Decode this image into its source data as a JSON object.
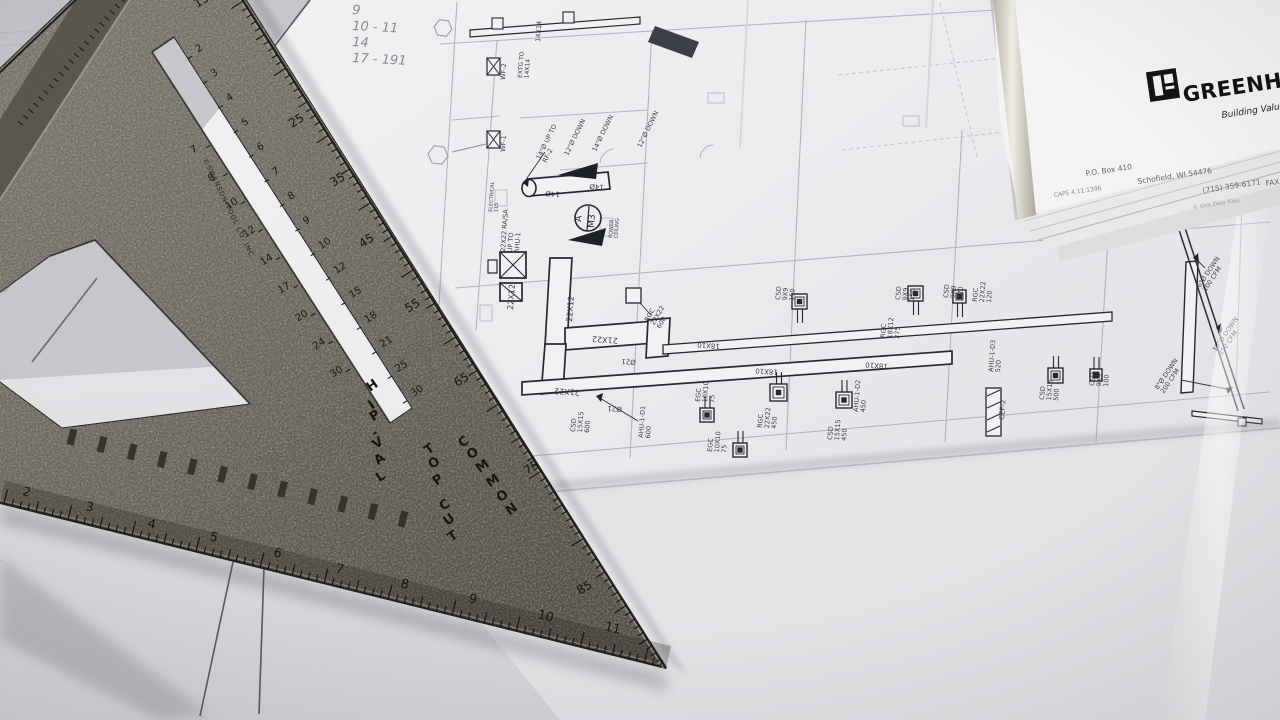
{
  "scene": {
    "description": "photo of HVAC blueprint sheets on a desk with a metal speed square on top"
  },
  "letterhead": {
    "brand": "GREENHECK",
    "tagline": "Building Value",
    "po_box": "P.O. Box 410",
    "city": "Schofield, WI 54476",
    "phone": "(715) 359-6171",
    "fax": "FAX",
    "code": "CAPS 4.11.1396",
    "fineprint": "© Unit Data Files"
  },
  "speed_square": {
    "brand": "©SWANSON TOOL CO. INC.",
    "label_hip_val": "HIP-VAL",
    "label_top_cut": "TOP CUT",
    "label_common": "COMMON",
    "inch_numbers": [
      "2",
      "3",
      "4",
      "5",
      "6",
      "7",
      "8",
      "9",
      "10",
      "11"
    ],
    "degree_numbers": [
      "15",
      "25",
      "35",
      "45",
      "55",
      "65",
      "75",
      "85"
    ],
    "upper_slot_scale": [
      "2",
      "3",
      "4",
      "5",
      "6",
      "7",
      "8",
      "9",
      "10",
      "12",
      "15",
      "18",
      "21",
      "25",
      "30"
    ],
    "lower_slot_scale": [
      "7",
      "8",
      "10",
      "12",
      "14",
      "17",
      "20",
      "24",
      "30"
    ]
  },
  "blueprint": {
    "handwritten_notes": [
      "9",
      "10 - 11",
      "14",
      "17 - 191"
    ],
    "section_marker": {
      "top": "A",
      "bottom": "M3"
    },
    "labels": [
      {
        "t": [
          "22X12"
        ],
        "x": 513,
        "y": 310,
        "r": -86,
        "s": 8
      },
      {
        "t": [
          "22X12"
        ],
        "x": 572,
        "y": 322,
        "r": -86,
        "s": 8
      },
      {
        "t": [
          "21X22"
        ],
        "x": 618,
        "y": 338,
        "r": 184,
        "s": 8
      },
      {
        "t": [
          "21X22"
        ],
        "x": 580,
        "y": 390,
        "r": 184,
        "s": 8
      },
      {
        "t": [
          "Ø21"
        ],
        "x": 636,
        "y": 360,
        "r": 184,
        "s": 7
      },
      {
        "t": [
          "Ø21"
        ],
        "x": 622,
        "y": 407,
        "r": 184,
        "s": 7
      },
      {
        "t": [
          "14Ø"
        ],
        "x": 560,
        "y": 192,
        "r": 184,
        "s": 7
      },
      {
        "t": [
          "14Ø"
        ],
        "x": 604,
        "y": 185,
        "r": 184,
        "s": 7
      },
      {
        "t": [
          "CSD",
          "15X15",
          "600"
        ],
        "x": 575,
        "y": 432,
        "r": -86,
        "s": 6.5,
        "lh": 7
      },
      {
        "t": [
          "AHU-1-D1",
          "600"
        ],
        "x": 643,
        "y": 438,
        "r": -86,
        "s": 6.5,
        "lh": 7
      },
      {
        "t": [
          "RGC",
          "22X22",
          "600"
        ],
        "x": 648,
        "y": 322,
        "r": -60,
        "s": 6.5,
        "lh": 7
      },
      {
        "t": [
          "18X10"
        ],
        "x": 720,
        "y": 344,
        "r": 184,
        "s": 7
      },
      {
        "t": [
          "18X10"
        ],
        "x": 778,
        "y": 370,
        "r": 184,
        "s": 7
      },
      {
        "t": [
          "18X10"
        ],
        "x": 888,
        "y": 364,
        "r": 184,
        "s": 7
      },
      {
        "t": [
          "EGC",
          "10X10",
          "75"
        ],
        "x": 700,
        "y": 402,
        "r": -86,
        "s": 6.5,
        "lh": 7
      },
      {
        "t": [
          "EGC",
          "10X10",
          "75"
        ],
        "x": 712,
        "y": 452,
        "r": -86,
        "s": 6.5,
        "lh": 7
      },
      {
        "t": [
          "RGC",
          "22X22",
          "450"
        ],
        "x": 762,
        "y": 428,
        "r": -86,
        "s": 6.5,
        "lh": 7
      },
      {
        "t": [
          "CSD",
          "15X15",
          "450"
        ],
        "x": 832,
        "y": 440,
        "r": -86,
        "s": 6.5,
        "lh": 7
      },
      {
        "t": [
          "AHU-1-D2",
          "450"
        ],
        "x": 858,
        "y": 412,
        "r": -86,
        "s": 6.5,
        "lh": 7
      },
      {
        "t": [
          "CSD",
          "9X9",
          "150"
        ],
        "x": 780,
        "y": 300,
        "r": -86,
        "s": 6.5,
        "lh": 7
      },
      {
        "t": [
          "CSD",
          "9X9",
          "150"
        ],
        "x": 900,
        "y": 300,
        "r": -86,
        "s": 6.5,
        "lh": 7
      },
      {
        "t": [
          "CSD",
          "9X9",
          "120"
        ],
        "x": 948,
        "y": 298,
        "r": -86,
        "s": 6.5,
        "lh": 7
      },
      {
        "t": [
          "RGC",
          "22X22",
          "120"
        ],
        "x": 977,
        "y": 302,
        "r": -86,
        "s": 6.5,
        "lh": 7
      },
      {
        "t": [
          "RGC",
          "18X12",
          "275"
        ],
        "x": 885,
        "y": 338,
        "r": -86,
        "s": 6.5,
        "lh": 7
      },
      {
        "t": [
          "AHU-1-D3",
          "520"
        ],
        "x": 993,
        "y": 372,
        "r": -86,
        "s": 6.5,
        "lh": 7
      },
      {
        "t": [
          "CSD",
          "15X15",
          "500"
        ],
        "x": 1044,
        "y": 400,
        "r": -86,
        "s": 6.5,
        "lh": 7
      },
      {
        "t": [
          "CSD",
          "9X9",
          "100"
        ],
        "x": 1094,
        "y": 386,
        "r": -86,
        "s": 6.5,
        "lh": 7
      },
      {
        "t": [
          "CEF-2"
        ],
        "x": 1004,
        "y": 420,
        "r": -86,
        "s": 7
      },
      {
        "t": [
          "6\"Ø DOWN",
          "100 CFM"
        ],
        "x": 1200,
        "y": 288,
        "r": -56,
        "s": 6.5,
        "lh": 7
      },
      {
        "t": [
          "10\"Ø DOWN",
          "350 CFM"
        ],
        "x": 1216,
        "y": 352,
        "r": -56,
        "s": 6.5,
        "lh": 7
      },
      {
        "t": [
          "8\"Ø DOWN",
          "200 CFM"
        ],
        "x": 1158,
        "y": 390,
        "r": -56,
        "s": 6.5,
        "lh": 7
      },
      {
        "t": [
          "22X22 RA/SA",
          "UP TO",
          "AHU-1"
        ],
        "x": 505,
        "y": 252,
        "r": -86,
        "s": 6.5,
        "lh": 7
      },
      {
        "t": [
          "14\"Ø UP TO",
          "RF-2"
        ],
        "x": 540,
        "y": 160,
        "r": -64,
        "s": 6.5,
        "lh": 7
      },
      {
        "t": [
          "12\"Ø DOWN"
        ],
        "x": 568,
        "y": 156,
        "r": -64,
        "s": 6.5
      },
      {
        "t": [
          "14\"Ø DOWN"
        ],
        "x": 596,
        "y": 152,
        "r": -64,
        "s": 6.5
      },
      {
        "t": [
          "12\"Ø DOWN"
        ],
        "x": 641,
        "y": 148,
        "r": -64,
        "s": 6.5
      },
      {
        "t": [
          "WF-2"
        ],
        "x": 505,
        "y": 80,
        "r": -86,
        "s": 6.5
      },
      {
        "t": [
          "WF-1"
        ],
        "x": 505,
        "y": 152,
        "r": -86,
        "s": 6.5
      },
      {
        "t": [
          "14X14"
        ],
        "x": 540,
        "y": 42,
        "r": -86,
        "s": 6.5
      },
      {
        "t": [
          "EXTG TO",
          "14X14"
        ],
        "x": 522,
        "y": 78,
        "r": -86,
        "s": 6,
        "lh": 6.5
      },
      {
        "t": [
          "16Ø"
        ],
        "x": 1100,
        "y": 42,
        "r": -60,
        "s": 7
      },
      {
        "t": [
          "POWER",
          "CEILING"
        ],
        "x": 612,
        "y": 238,
        "r": -86,
        "s": 5,
        "lh": 5.5
      },
      {
        "t": [
          "ELECTRICAL",
          "115"
        ],
        "x": 492,
        "y": 212,
        "r": -86,
        "s": 5,
        "lh": 5.5
      }
    ]
  }
}
